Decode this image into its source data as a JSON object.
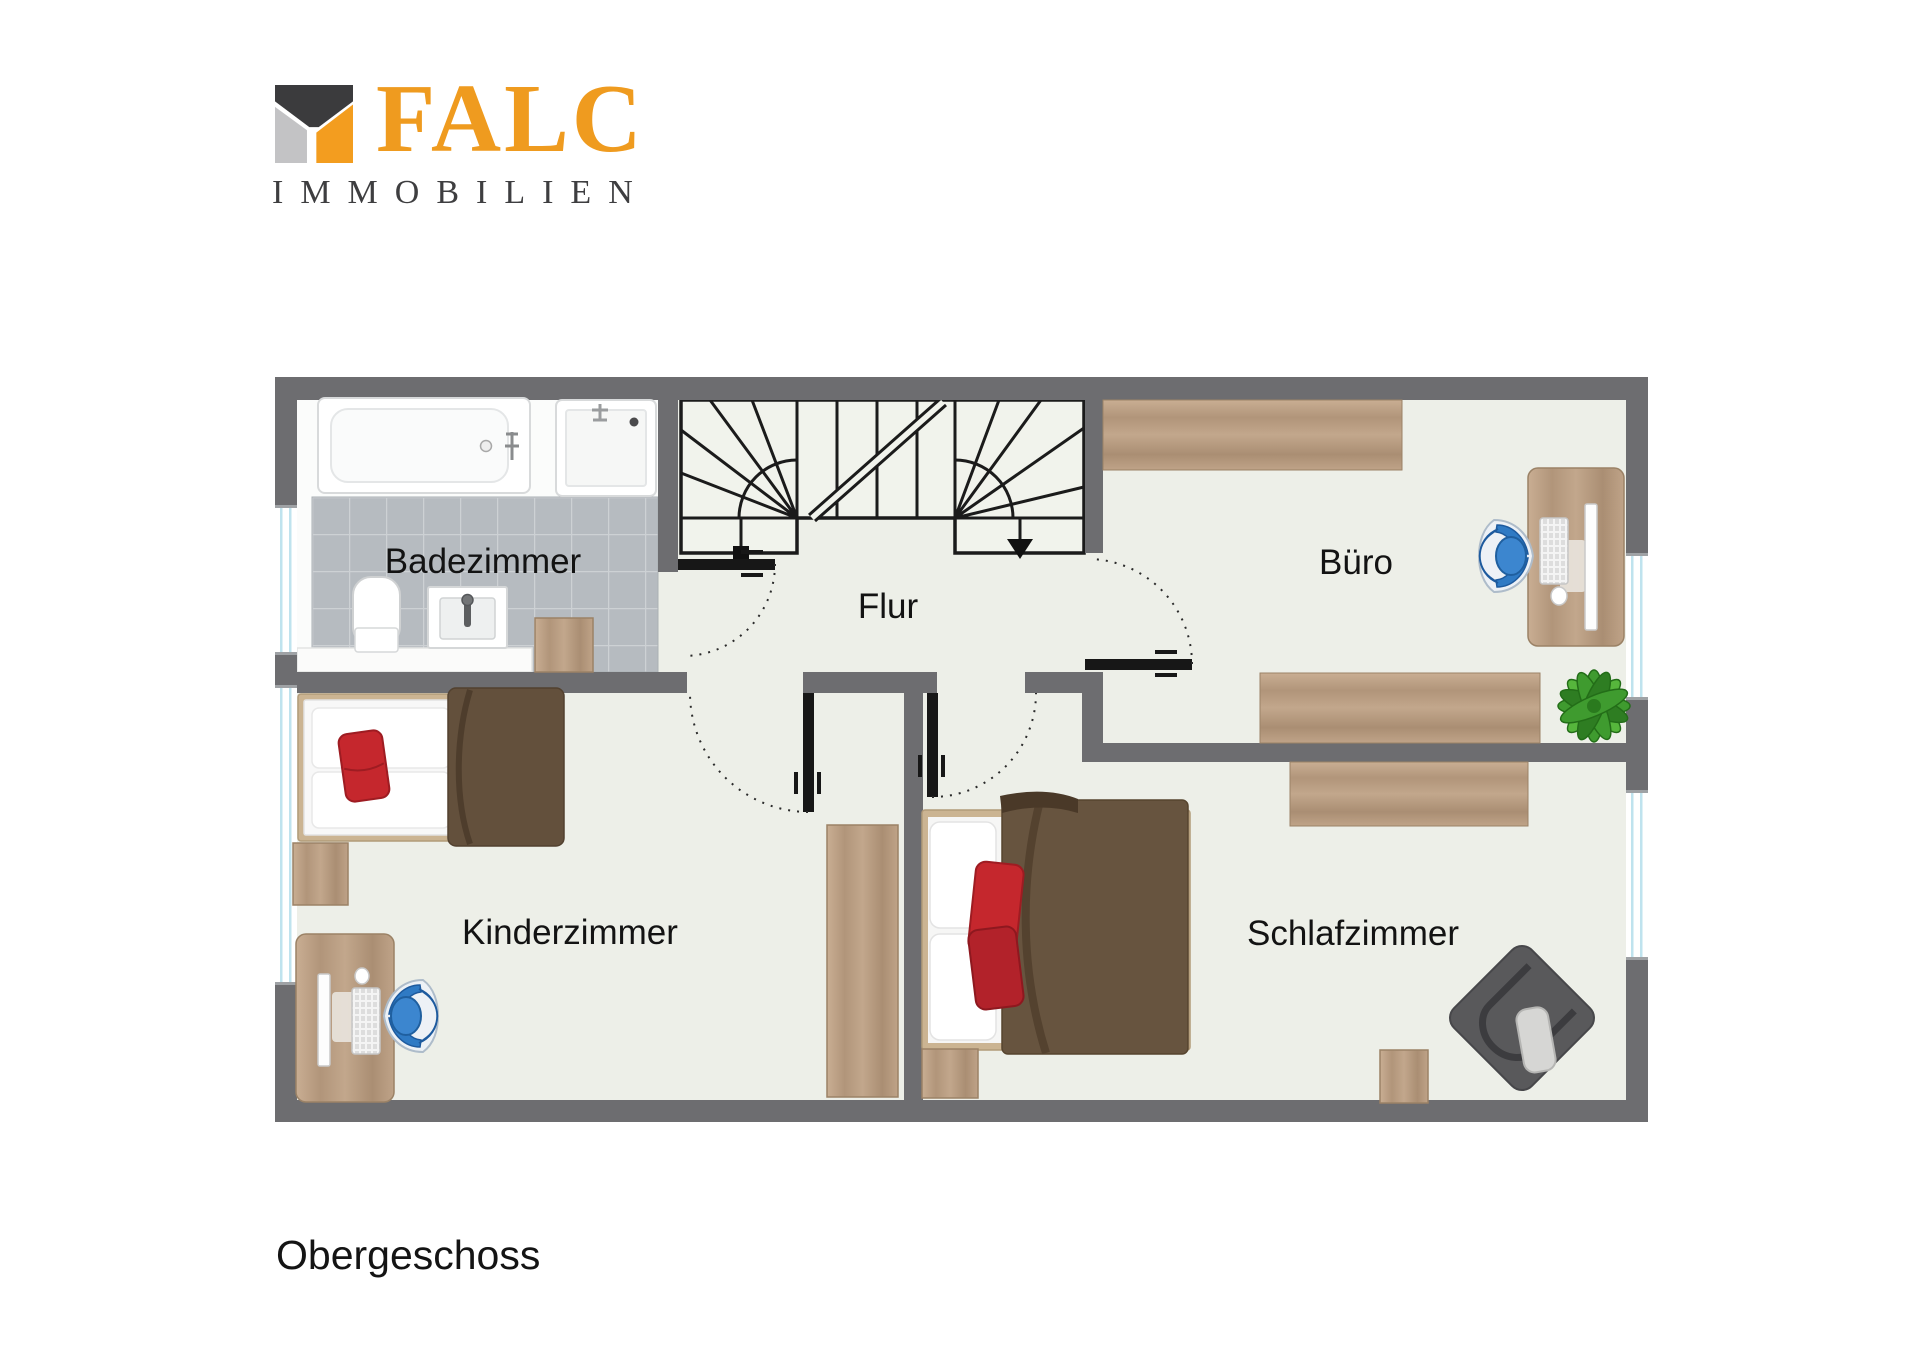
{
  "logo": {
    "brand": "FALC",
    "subtitle": "IMMOBILIEN",
    "mark_colors": {
      "top": "#3b3b3d",
      "left": "#c3c3c5",
      "right": "#f39d1f"
    }
  },
  "plan": {
    "title": "Obergeschoss",
    "rooms": [
      {
        "id": "badezimmer",
        "label": "Badezimmer",
        "furniture": [
          "bathtub",
          "shower",
          "toilet",
          "sink",
          "bath-cabinet"
        ]
      },
      {
        "id": "flur",
        "label": "Flur",
        "furniture": [
          "staircase"
        ]
      },
      {
        "id": "buero",
        "label": "Büro",
        "furniture": [
          "sideboard",
          "desk",
          "office-chair",
          "plant"
        ]
      },
      {
        "id": "kinderzimmer",
        "label": "Kinderzimmer",
        "furniture": [
          "single-bed",
          "nightstand",
          "wardrobe",
          "desk",
          "office-chair"
        ]
      },
      {
        "id": "schlafzimmer",
        "label": "Schlafzimmer",
        "furniture": [
          "double-bed",
          "sideboard",
          "dresser",
          "armchair"
        ]
      }
    ]
  },
  "colors": {
    "brand_orange": "#f39d1f",
    "wall_gray": "#6d6d70",
    "floor": "#edefe8",
    "tile_gray": "#b6bbc0",
    "wood": "#b79c82",
    "accent_red": "#c5272d",
    "chair_blue": "#2f7ac4",
    "plant_green": "#3f9b2f"
  }
}
